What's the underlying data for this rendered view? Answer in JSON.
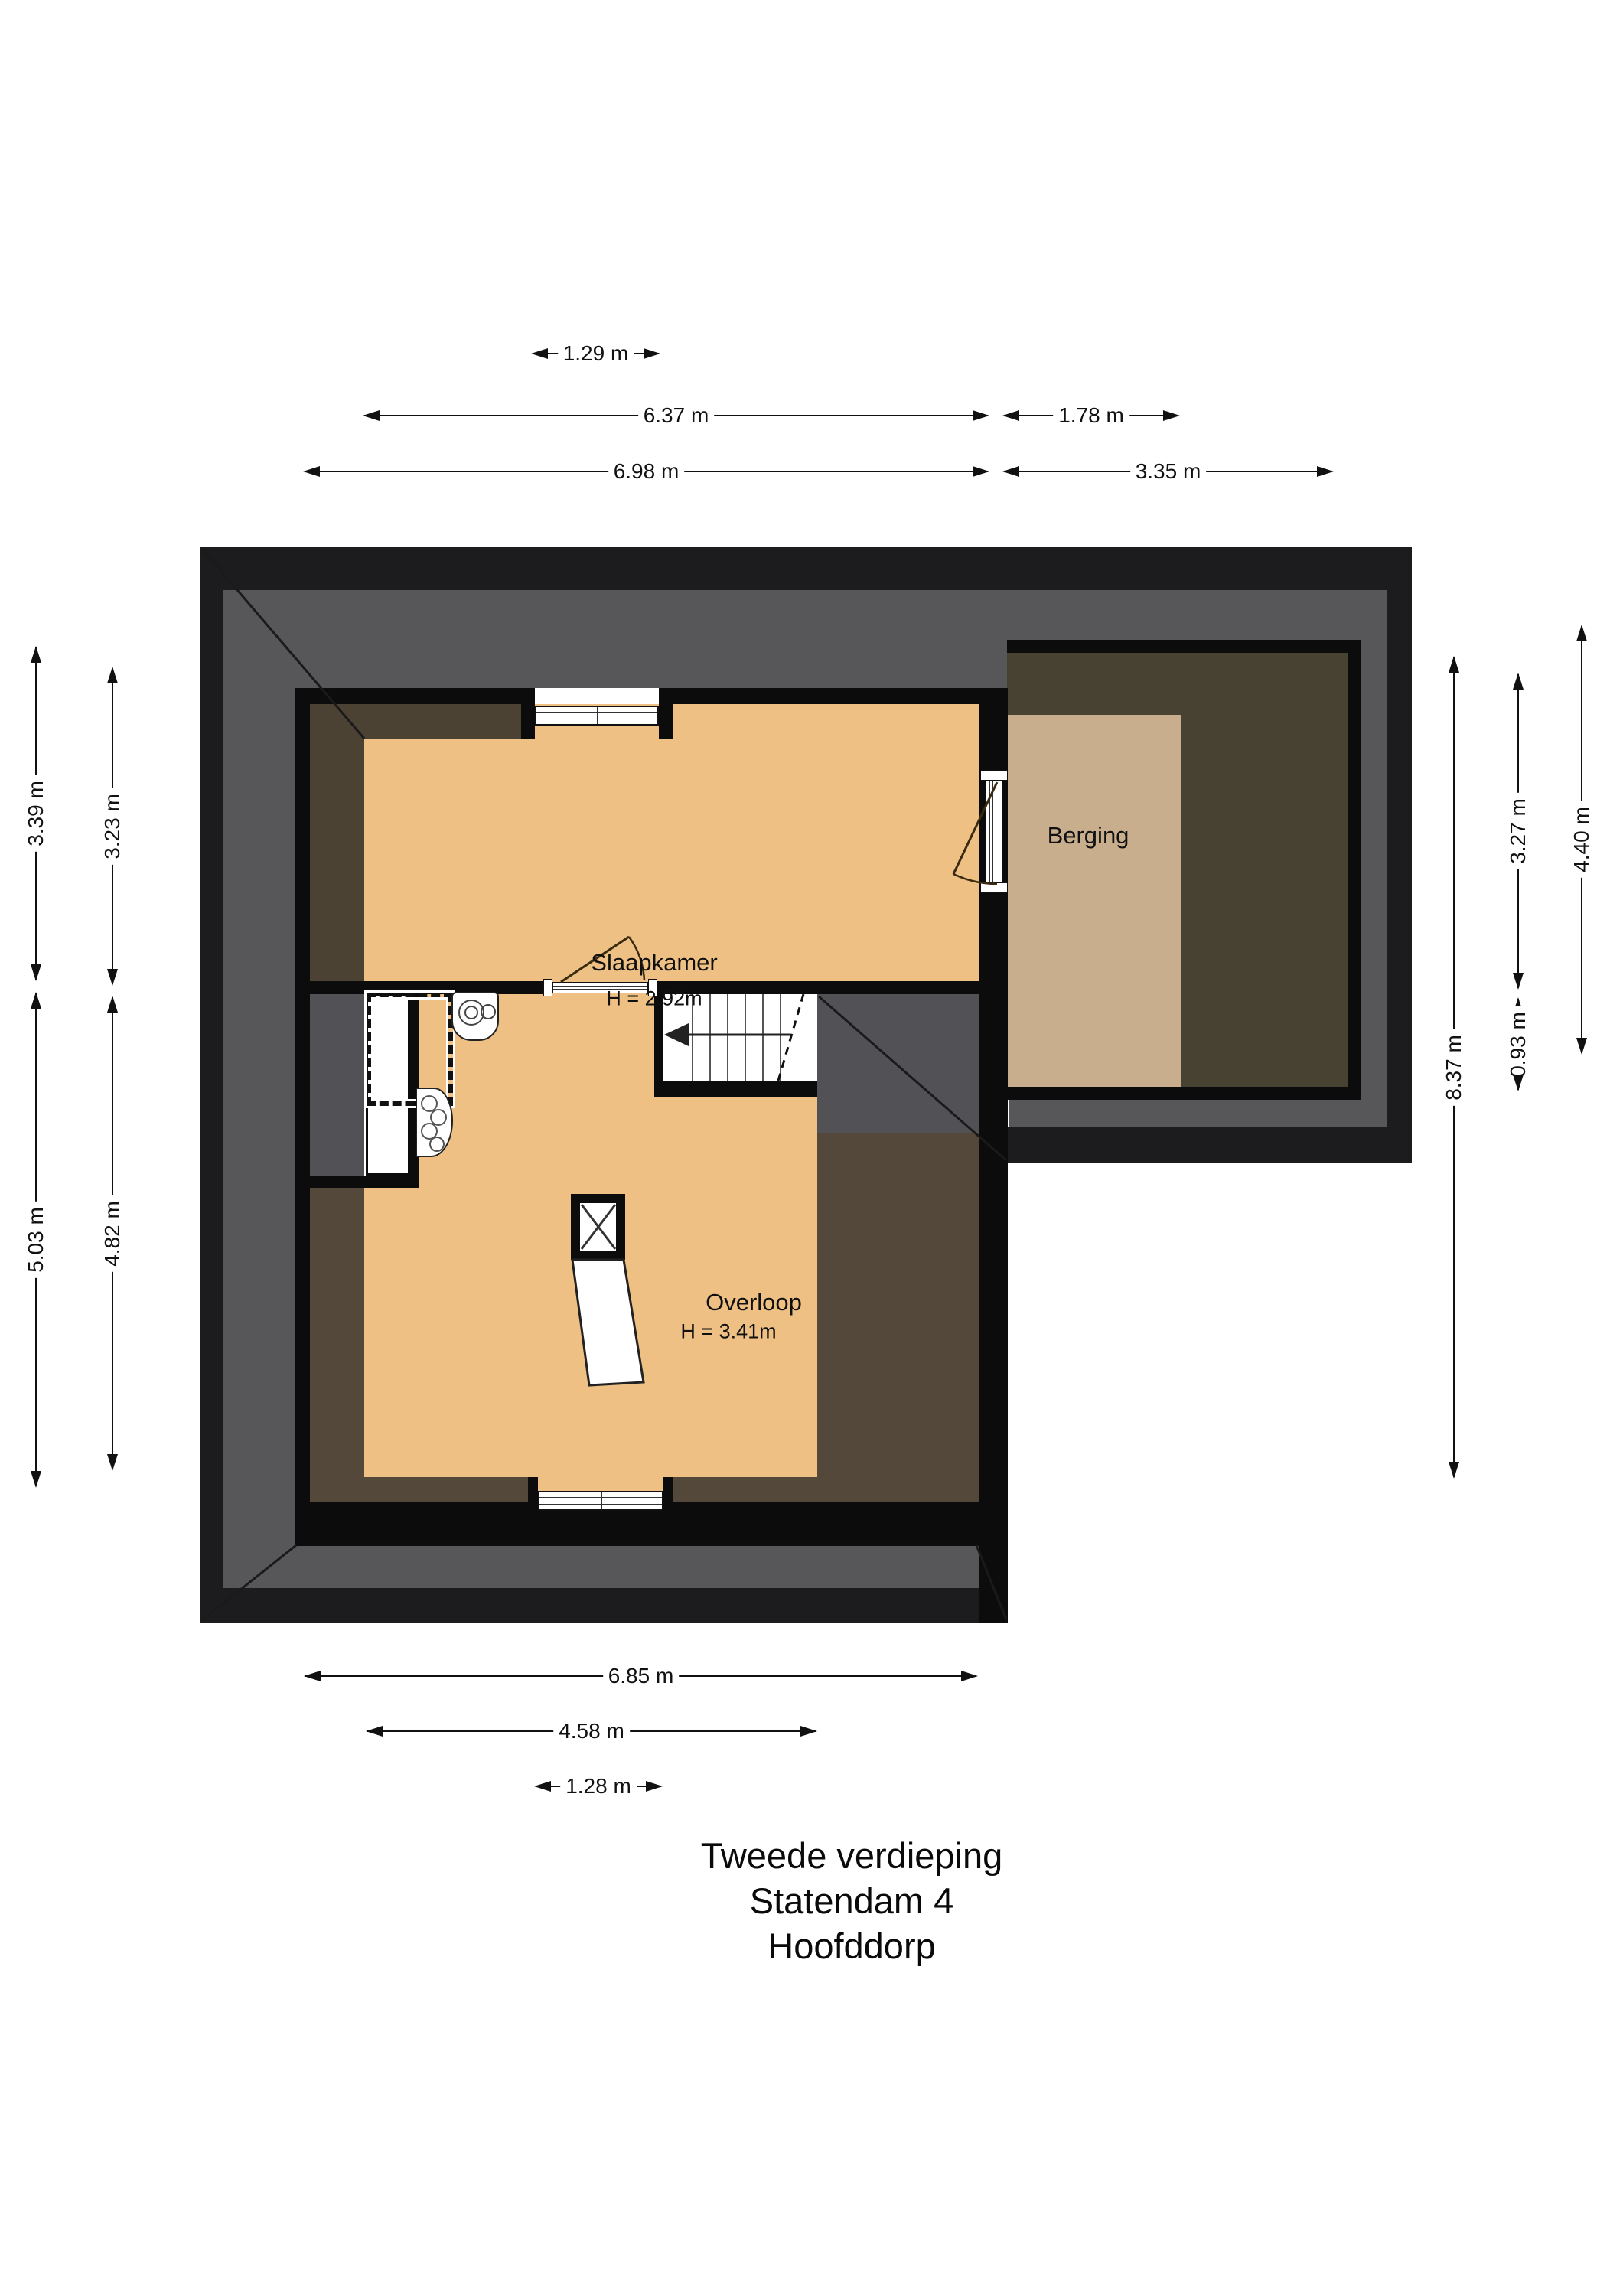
{
  "title": {
    "line1": "Tweede verdieping",
    "line2": "Statendam 4",
    "line3": "Hoofddorp"
  },
  "rooms": {
    "slaapkamer": {
      "name": "Slaapkamer",
      "height": "H = 2.92m"
    },
    "overloop": {
      "name": "Overloop",
      "height": "H = 3.41m"
    },
    "berging": {
      "name": "Berging"
    }
  },
  "dims": {
    "d129": {
      "label": "1.29 m"
    },
    "d637": {
      "label": "6.37 m"
    },
    "d178": {
      "label": "1.78 m"
    },
    "d698": {
      "label": "6.98 m"
    },
    "d335": {
      "label": "3.35 m"
    },
    "d685": {
      "label": "6.85 m"
    },
    "d458": {
      "label": "4.58 m"
    },
    "d128": {
      "label": "1.28 m"
    },
    "d339": {
      "label": "3.39 m"
    },
    "d503": {
      "label": "5.03 m"
    },
    "d323": {
      "label": "3.23 m"
    },
    "d482": {
      "label": "4.82 m"
    },
    "d837": {
      "label": "8.37 m"
    },
    "d327": {
      "label": "3.27 m"
    },
    "d093": {
      "label": "0.93 m"
    },
    "d440": {
      "label": "4.40 m"
    }
  },
  "icons": {
    "stairs_arrow": "stairs-direction-arrow-icon",
    "chimney": "chimney-flue-icon",
    "boiler": "boiler-icon",
    "hob": "sink-hob-icon"
  },
  "colors": {
    "floor_orange": "#eec084",
    "floor_tan": "#c9ae8e",
    "roof_gray": "#57575a",
    "low_headroom_brown": "#54483a",
    "attic_olive": "#474231",
    "outer_wall": "#1c1c1e",
    "inner_wall": "#0c0c0c"
  }
}
